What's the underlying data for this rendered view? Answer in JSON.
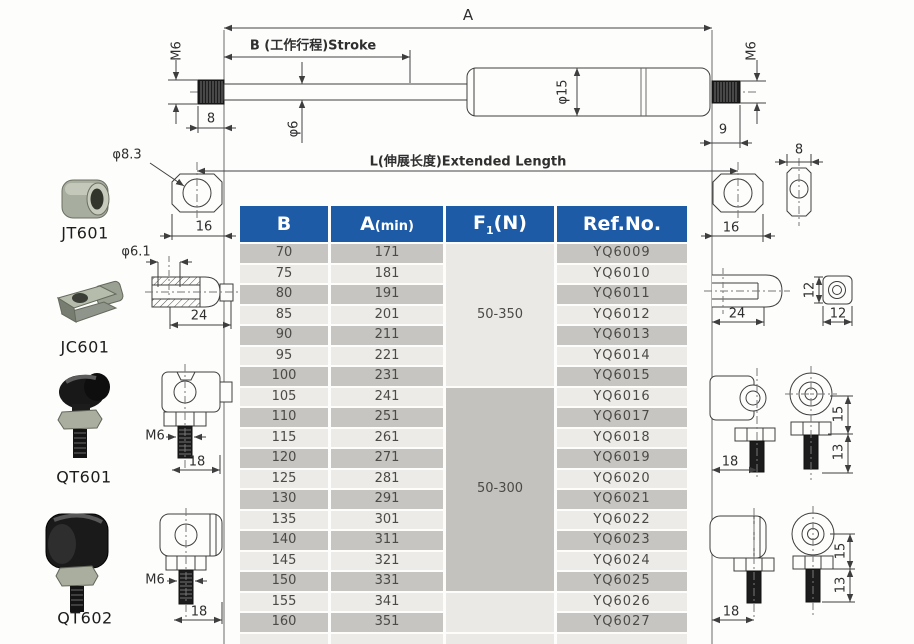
{
  "diagram": {
    "dim_labels": {
      "a": "A",
      "b_stroke": "B (工作行程)Stroke",
      "extended": "L(伸展长度)Extended Length",
      "m6": "M6",
      "phi6": "φ6",
      "phi15": "φ15",
      "n8": "8",
      "n9": "9",
      "phi8_3": "φ8.3",
      "n16": "16",
      "phi6_1": "φ6.1",
      "n24": "24",
      "n12": "12",
      "n18": "18",
      "n15": "15",
      "n13": "13"
    },
    "fittings": {
      "jt601": "JT601",
      "jc601": "JC601",
      "qt601": "QT601",
      "qt602": "QT602"
    }
  },
  "table": {
    "headers": {
      "b": "B",
      "a_main": "A",
      "a_sub": "(min)",
      "f_main": "F",
      "f_sub": "1",
      "f_rest": "(N)",
      "ref": "Ref.No."
    },
    "rows": [
      {
        "b": "70",
        "a": "171",
        "ref": "YQ6009"
      },
      {
        "b": "75",
        "a": "181",
        "ref": "YQ6010"
      },
      {
        "b": "80",
        "a": "191",
        "ref": "YQ6011"
      },
      {
        "b": "85",
        "a": "201",
        "ref": "YQ6012"
      },
      {
        "b": "90",
        "a": "211",
        "ref": "YQ6013"
      },
      {
        "b": "95",
        "a": "221",
        "ref": "YQ6014"
      },
      {
        "b": "100",
        "a": "231",
        "ref": "YQ6015"
      },
      {
        "b": "105",
        "a": "241",
        "ref": "YQ6016"
      },
      {
        "b": "110",
        "a": "251",
        "ref": "YQ6017"
      },
      {
        "b": "115",
        "a": "261",
        "ref": "YQ6018"
      },
      {
        "b": "120",
        "a": "271",
        "ref": "YQ6019"
      },
      {
        "b": "125",
        "a": "281",
        "ref": "YQ6020"
      },
      {
        "b": "130",
        "a": "291",
        "ref": "YQ6021"
      },
      {
        "b": "135",
        "a": "301",
        "ref": "YQ6022"
      },
      {
        "b": "140",
        "a": "311",
        "ref": "YQ6023"
      },
      {
        "b": "145",
        "a": "321",
        "ref": "YQ6024"
      },
      {
        "b": "150",
        "a": "331",
        "ref": "YQ6025"
      },
      {
        "b": "155",
        "a": "341",
        "ref": "YQ6026"
      },
      {
        "b": "160",
        "a": "351",
        "ref": "YQ6027"
      }
    ],
    "force_groups": [
      {
        "label": "50-350",
        "span": 7,
        "shade": "light"
      },
      {
        "label": "50-300",
        "span": 10,
        "shade": "dark"
      },
      {
        "label": "",
        "span": 2,
        "shade": "light"
      }
    ]
  },
  "colors": {
    "header_blue": "#1d5ba6",
    "row_dark": "#c6c5c1",
    "row_light": "#ecebe7",
    "force_cell_dark": "#c3c2be",
    "force_cell_light": "#eae9e5"
  }
}
